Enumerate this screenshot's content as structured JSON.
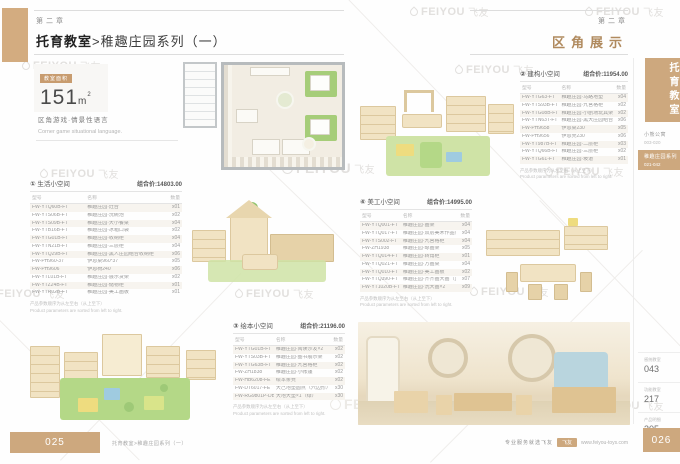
{
  "left_page": {
    "chapter": "第二章",
    "title_bold": "托育教室",
    "title_rest": ">稚趣庄园系列（一）",
    "area_badge": "教室面积",
    "area_value": "151",
    "area_unit": "m",
    "area_unit_sup": "2",
    "tagline_cn": "区角游戏·情景性语言",
    "tagline_en": "Corner game situational language."
  },
  "right_page": {
    "chapter": "第二章",
    "title": "区角展示"
  },
  "sidebar": {
    "tab": "托育教室",
    "items": [
      {
        "label": "小熊公寓",
        "range": "003-020"
      },
      {
        "label": "稚趣庄园系列",
        "range": "021-042"
      }
    ],
    "sections": [
      {
        "label": "感统教室",
        "page": "043"
      },
      {
        "label": "功能教室",
        "page": "217"
      },
      {
        "label": "产品明细",
        "page": "305"
      }
    ]
  },
  "table_cols": [
    "型号",
    "名称",
    "数量"
  ],
  "table_note_cn": "产品参数顺序为从左至右（从上至下）",
  "table_note_en": "Product parameters are sorted from left to right.",
  "tables": [
    {
      "num": "①",
      "name": "生活小空间",
      "price": "组合价:14803.00",
      "rows": [
        {
          "code": "FW-YTQ60B-FT",
          "name": "稚趣庄园·灶台",
          "qty": "x01"
        },
        {
          "code": "FW-YTS06B-FT",
          "name": "稚趣庄园·洗碗池",
          "qty": "x02"
        },
        {
          "code": "FW-YTS09B-FT",
          "name": "稚趣庄园·大小餐桌",
          "qty": "x04"
        },
        {
          "code": "FW-YTB16B-FT",
          "name": "稚趣庄园·冰箱口袋",
          "qty": "x02"
        },
        {
          "code": "FW-YTG01B-FT",
          "name": "稚趣庄园·收纳柜",
          "qty": "x04"
        },
        {
          "code": "FW-YTN21B-FT",
          "name": "稚趣庄园·三层柜",
          "qty": "x04"
        },
        {
          "code": "FW-YTQ29B-FT",
          "name": "稚趣庄园·黑人庄园组合收纳柜",
          "qty": "x06"
        },
        {
          "code": "FW-PH960-37",
          "name": "伊恩桌960*37",
          "qty": "x05"
        },
        {
          "code": "FW-PH9606",
          "name": "伊恩椅240",
          "qty": "x06"
        },
        {
          "code": "FW-YTL01B-FT",
          "name": "稚趣庄园·展示货架",
          "qty": "x02"
        },
        {
          "code": "FW-YTZ24B-FT",
          "name": "稚趣庄园·储物柜",
          "qty": "x01"
        },
        {
          "code": "FW-YTR02B-FT",
          "name": "稚趣庄园·美工画板",
          "qty": "x01"
        }
      ]
    },
    {
      "num": "②",
      "name": "建构小空间",
      "price": "组合价:11954.00",
      "rows": [
        {
          "code": "FW-YTG63-FT",
          "name": "稚趣庄园·马路地垫",
          "qty": "x04"
        },
        {
          "code": "FW-YTS93B-FT",
          "name": "稚趣庄园·九宫格柜",
          "qty": "x02"
        },
        {
          "code": "FW-YTG08B-FT",
          "name": "稚趣庄园·小剧场玩具架",
          "qty": "x02"
        },
        {
          "code": "FW-YTN63T-FT",
          "name": "稚趣庄园·黑大庄园组合收纳柜",
          "qty": "x06"
        },
        {
          "code": "FW-PH9658",
          "name": "伊恩桌230",
          "qty": "x05"
        },
        {
          "code": "FW-PH9656",
          "name": "伊恩凳230",
          "qty": "x06"
        },
        {
          "code": "FW-YT987B-FT",
          "name": "稚趣庄园·二层柜",
          "qty": "x03"
        },
        {
          "code": "FW-YTQ66B-FT",
          "name": "稚趣庄园·三层柜",
          "qty": "x02"
        },
        {
          "code": "FW-YTG61-FT",
          "name": "稚趣庄园·坡道",
          "qty": "x01"
        }
      ]
    },
    {
      "num": "③",
      "name": "绘本小空间",
      "price": "组合价:21196.00",
      "rows": [
        {
          "code": "FW-YTG01B-FT",
          "name": "稚趣庄园·阅读沙发×2",
          "qty": "x02"
        },
        {
          "code": "FW-YTS03B-FT",
          "name": "稚趣庄园·图书展示架",
          "qty": "x02"
        },
        {
          "code": "FW-YTG63B-FT",
          "name": "稚趣庄园·九宫格柜",
          "qty": "x02"
        },
        {
          "code": "FW-ZH1838",
          "name": "稚趣庄园·小帐篷",
          "qty": "x02"
        },
        {
          "code": "FW-HB6208-FE",
          "name": "绘本条凳",
          "qty": "x02"
        },
        {
          "code": "FW-DT6017-FE",
          "name": "大己地垫圆点（六边形）",
          "qty": "x30"
        },
        {
          "code": "FW-RG9801P-DB",
          "name": "大地大垫×1（绿）",
          "qty": "x30"
        }
      ]
    },
    {
      "num": "④",
      "name": "美工小空间",
      "price": "组合价:14995.00",
      "rows": [
        {
          "code": "FW-YTQ001-FT",
          "name": "稚趣庄园·画架",
          "qty": "x04"
        },
        {
          "code": "FW-YTQ017-FT",
          "name": "稚趣庄园·双层美术作品架",
          "qty": "x04"
        },
        {
          "code": "FW-YTS002-FT",
          "name": "稚趣庄园·九宫格柜",
          "qty": "x04"
        },
        {
          "code": "FW-ZH1938",
          "name": "稚趣庄园·晾画架",
          "qty": "x05"
        },
        {
          "code": "FW-YTQ014-FT",
          "name": "稚趣庄园·转角柜",
          "qty": "x01"
        },
        {
          "code": "FW-YTQ021-FT",
          "name": "稚趣庄园·方画桌",
          "qty": "x04"
        },
        {
          "code": "FW-YTQ010-FT",
          "name": "稚趣庄园·美工画板",
          "qty": "x02"
        },
        {
          "code": "FW-YTQ390-FT",
          "name": "稚趣庄园·齐齐画大画（蓝白）",
          "qty": "x07"
        },
        {
          "code": "FW-YT1020B-FT",
          "name": "稚趣庄园·洗大画×2",
          "qty": "x09"
        }
      ]
    }
  ],
  "footer": {
    "left_page_num": "025",
    "left_text": "托育教室>稚趣庄园系列（一）",
    "slogan": "专业服务就选飞友",
    "brand": "飞友",
    "url": "www.feiyou-toys.com",
    "right_page_num": "026"
  },
  "watermark": {
    "latin": "FEIYOU",
    "cn": "飞友"
  }
}
